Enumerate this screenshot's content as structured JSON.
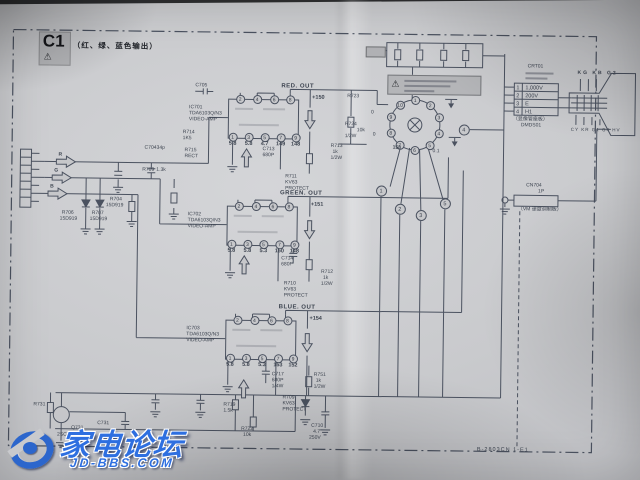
{
  "title": {
    "code": "C1",
    "note": "（红、绿、蓝色输出）"
  },
  "footer": {
    "doc_ref": "B-2803CN 1-E1"
  },
  "watermark": {
    "name": "家电论坛",
    "site": "JD-BBS.COM"
  },
  "signals": {
    "r": "R",
    "g": "G",
    "b": "B"
  },
  "channels": [
    {
      "out_label": "RED. OUT",
      "out_volt": "+150",
      "ic_ref": "IC701",
      "ic_part": "TDA6103Q/N3",
      "ic_func": "VIDEO-AMP",
      "top_pins": [
        "2",
        "4",
        "6",
        "8"
      ],
      "bot_pins": [
        "1",
        "3",
        "5",
        "7",
        "9"
      ],
      "volts": [
        "5.8",
        "5.8",
        "4.7",
        "149",
        "148"
      ],
      "protect": [
        "R711",
        "KV63",
        "PROTECT"
      ]
    },
    {
      "out_label": "GREEN. OUT",
      "out_volt": "+151",
      "ic_ref": "IC702",
      "ic_part": "TDA6103Q/N3",
      "ic_func": "VIDEO-AMP",
      "top_pins": [
        "2",
        "4",
        "6",
        "8"
      ],
      "bot_pins": [
        "1",
        "3",
        "5",
        "7",
        "9"
      ],
      "volts": [
        "5.8",
        "5.8",
        "5.3",
        "150",
        "148"
      ],
      "protect": [
        "R710",
        "KV63",
        "PROTECT"
      ]
    },
    {
      "out_label": "BLUE. OUT",
      "out_volt": "+154",
      "ic_ref": "IC703",
      "ic_part": "TDA6103Q/N3",
      "ic_func": "VIDEO-AMP",
      "top_pins": [
        "2",
        "4",
        "6",
        "8"
      ],
      "bot_pins": [
        "1",
        "3",
        "5",
        "7",
        "9"
      ],
      "volts": [
        "5.8",
        "5.8",
        "5.3",
        "153",
        "152"
      ],
      "protect": [
        "R709",
        "KV63",
        "PROTECT"
      ]
    }
  ],
  "crt": {
    "ref": "CRT01",
    "socket_pins": [
      "1",
      "2",
      "3",
      "4",
      "5",
      "6",
      "7",
      "8",
      "9",
      "10"
    ],
    "ring_refs": [
      "1",
      "2",
      "3",
      "5"
    ],
    "right_ref": "4",
    "pin_volt": "158",
    "v0a": "0",
    "v0b": "0",
    "v01": "0.1",
    "table": [
      [
        "1",
        "1,000V"
      ],
      [
        "2",
        "200V"
      ],
      [
        "3",
        "E"
      ],
      [
        "4",
        "H1"
      ]
    ],
    "board_cn": "（显像管座板）",
    "board_ref": "DMDS01",
    "guns_top": "KG KB G2",
    "guns_bot": "CY KR G1 G4 HV"
  },
  "vm": {
    "conn": "CN704",
    "pins": "1P",
    "label": "（VM 速度调制板）"
  },
  "parts": {
    "c705": "C705",
    "r714": "R714",
    "r714v": "1K5",
    "r715": "R715",
    "r715v": "RECT",
    "c704": "C704",
    "c704v": "34p",
    "r709": "R709",
    "r709v": "1.3k",
    "r704": "R704",
    "r704v": "15D919",
    "r706": "R706",
    "r706v": "15D919",
    "r707": "R707",
    "r707v": "15D919",
    "c713": "C713",
    "c713v": "680P",
    "c714": "C714",
    "c714v": "680P",
    "c717": "C717",
    "c717v": "680P",
    "c717w": "1/4W",
    "r713": "R713",
    "r713v": "1k",
    "r713w": "1/2W",
    "r723": "R723",
    "r724": "R724",
    "r724v": "10k",
    "r724w": "1/2W",
    "r712": "R712",
    "r712v": "1k",
    "r712w": "1/2W",
    "r719": "R719",
    "r719v": "1.5k",
    "r722": "R722",
    "r722v": "10k",
    "c710": "C710",
    "c710v": "4.7",
    "c710w": "250V",
    "r751": "R751",
    "r751v": "1k",
    "r751w": "1/2W",
    "q731": "Q731",
    "q731p": "2SC2412K",
    "r731": "R731",
    "c731": "C731"
  }
}
